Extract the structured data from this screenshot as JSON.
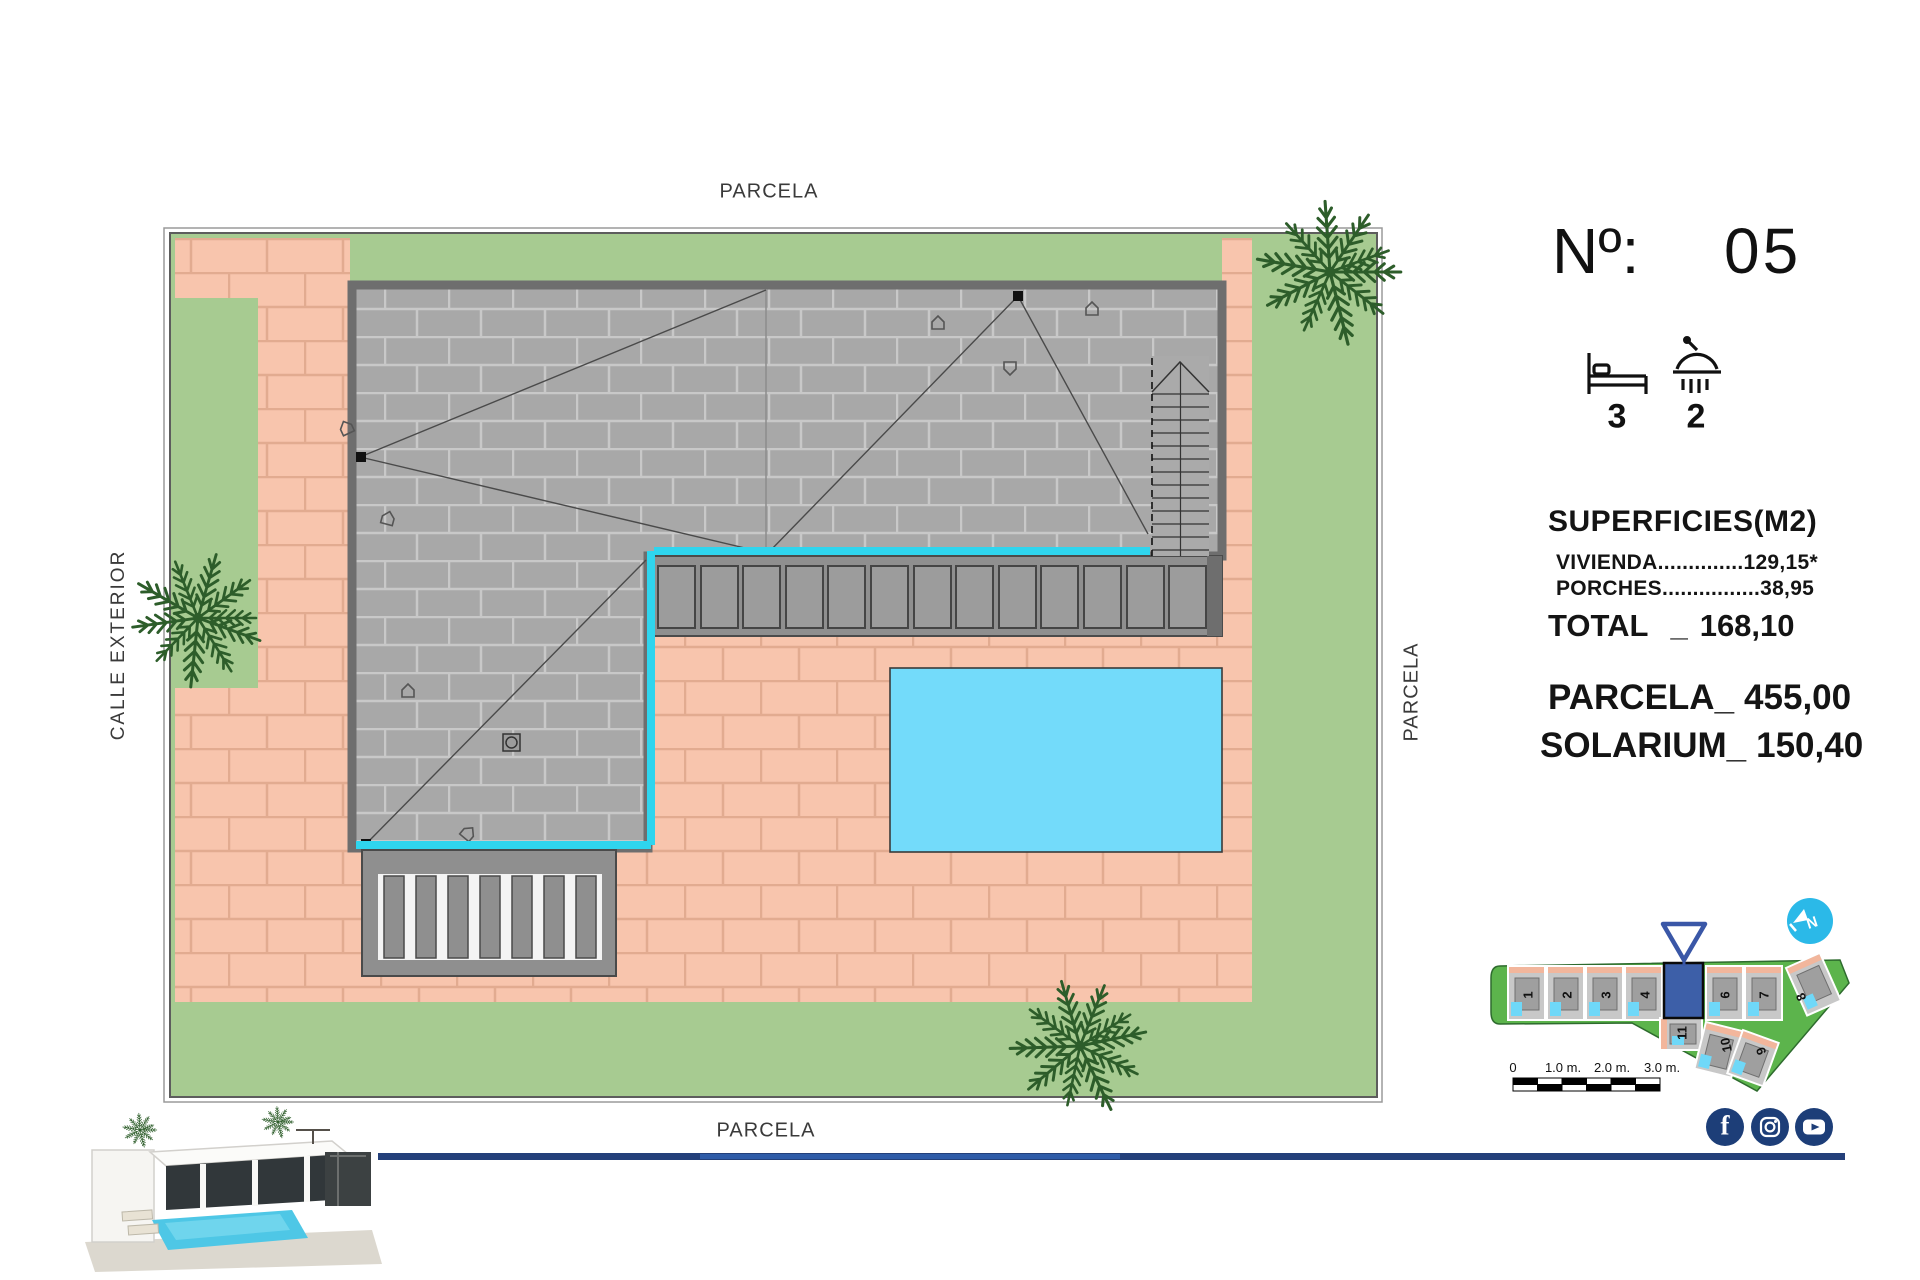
{
  "plan": {
    "label_top": "PARCELA",
    "label_bottom": "PARCELA",
    "label_right": "PARCELA",
    "label_left": "CALLE EXTERIOR"
  },
  "panel": {
    "numero_label": "Nº:",
    "numero_value": "05",
    "bedrooms": "3",
    "bathrooms": "2",
    "superficies_title": "SUPERFICIES(M2)",
    "vivienda_line": "VIVIENDA..............129,15*",
    "porches_line": "PORCHES................38,95",
    "total_label": "TOTAL",
    "total_sep": "_",
    "total_value": "168,10",
    "parcela_label": "PARCELA_",
    "parcela_value": "455,00",
    "solarium_label": "SOLARIUM_",
    "solarium_value": "150,40"
  },
  "minimap": {
    "plot_labels": [
      "1",
      "2",
      "3",
      "4",
      "6",
      "7",
      "8",
      "11",
      "10",
      "9"
    ],
    "highlighted_plot": "5",
    "scale_labels": [
      "0",
      "1.0 m.",
      "2.0 m.",
      "3.0 m."
    ]
  },
  "icons": {
    "bed": "bed-icon",
    "shower": "shower-icon",
    "compass_letter": "N",
    "facebook_glyph": "f",
    "social": [
      "facebook",
      "instagram",
      "youtube"
    ]
  },
  "colors": {
    "lawn_green": "#a7cb91",
    "paving_salmon": "#f8c5ad",
    "roof_gray": "#a8a8a8",
    "pool_cyan": "#73dbfa",
    "edge_cyan": "#2fd5ee",
    "navy": "#24407a",
    "minimap_green": "#5cb44c",
    "highlight_blue": "#3d5fa8",
    "compass_cyan": "#2bb9e8"
  }
}
